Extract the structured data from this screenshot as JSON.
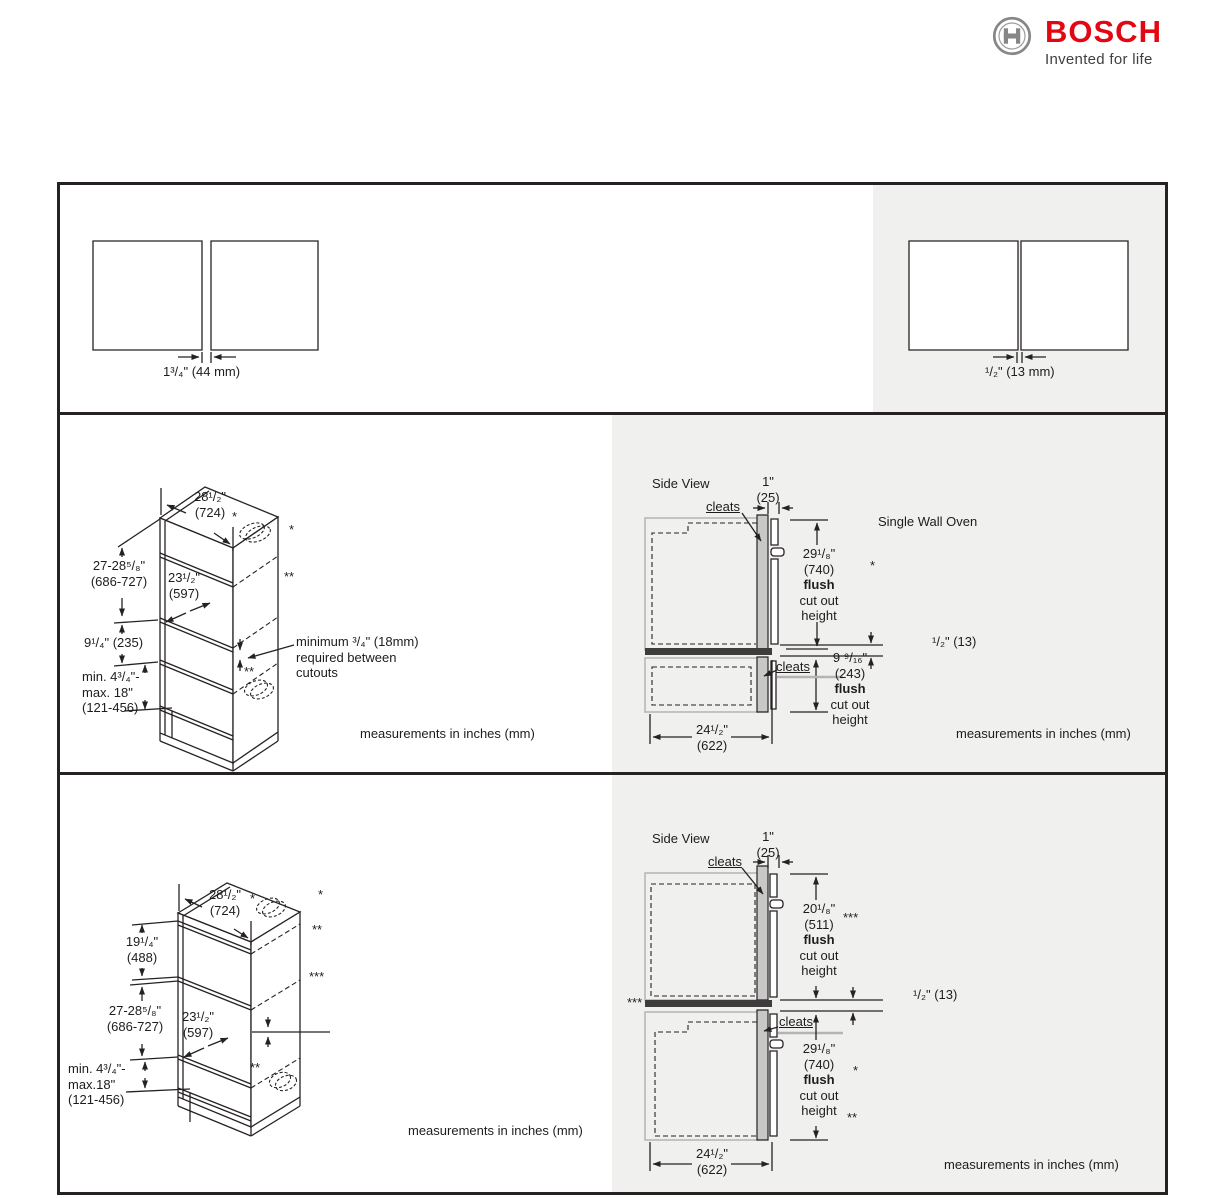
{
  "logo": {
    "brand": "BOSCH",
    "tagline": "Invented for life"
  },
  "row1": {
    "left_gap": "1³/₄\" (44 mm)",
    "right_gap": "¹/₂\" (13 mm)"
  },
  "common": {
    "side_view": "Side View",
    "cleats": "cleats",
    "flush": "flush",
    "cut_out": "cut out",
    "height": "height",
    "units": "measurements in inches (mm)",
    "one_inch": "1\"",
    "one_inch_mm": "(25)",
    "width": "24¹/₂\"",
    "width_mm": "(622)",
    "gap_half": "¹/₂\" (13)",
    "star": "*",
    "star2": "**",
    "star3": "***"
  },
  "cab1": {
    "top_width": "28¹/₂\"",
    "top_width_mm": "(724)",
    "cutout_height": "27-28⁵/₈\"",
    "cutout_height_mm": "(686-727)",
    "inner_width": "23¹/₂\"",
    "inner_width_mm": "(597)",
    "mid_height": "9¹/₄\" (235)",
    "base_min": "min. 4³/₄\"-",
    "base_max": "max. 18\"",
    "base_mm": "(121-456)",
    "note_line1": "minimum ³/₄\" (18mm)",
    "note_line2": "required between",
    "note_line3": "cutouts"
  },
  "side1": {
    "upper_height": "29¹/₈\"",
    "upper_height_mm": "(740)",
    "lower_height": "9 ⁹/₁₆\"",
    "lower_height_mm": "(243)",
    "oven_label": "Single Wall Oven"
  },
  "cab2": {
    "top_width": "28¹/₂\"",
    "top_width_mm": "(724)",
    "upper_height": "19¹/₄\"",
    "upper_height_mm": "(488)",
    "cutout_height": "27-28⁵/₈\"",
    "cutout_height_mm": "(686-727)",
    "inner_width": "23¹/₂\"",
    "inner_width_mm": "(597)",
    "base_min": "min. 4³/₄\"-",
    "base_max": "max.18\"",
    "base_mm": "(121-456)"
  },
  "side2": {
    "upper_height": "20¹/₈\"",
    "upper_height_mm": "(511)",
    "lower_height": "29¹/₈\"",
    "lower_height_mm": "(740)"
  }
}
